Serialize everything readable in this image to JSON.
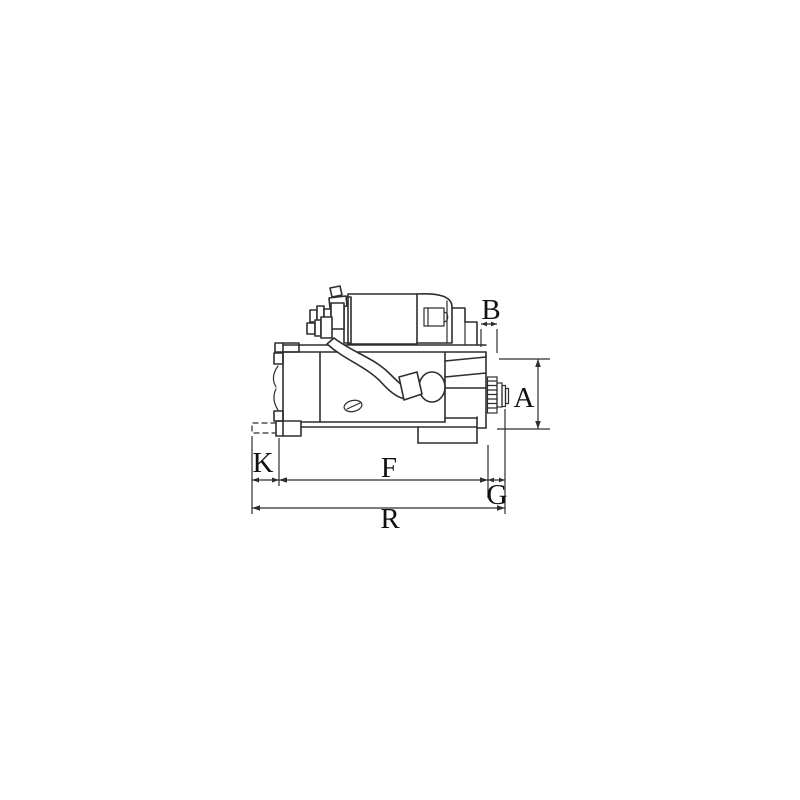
{
  "page": {
    "background_color": "#ffffff"
  },
  "diagram": {
    "kind": "technical-dimension-drawing",
    "subject": "starter motor side view",
    "line_color": "#2e2e2e",
    "label_color": "#111111",
    "labels": {
      "b": "B",
      "a": "A",
      "k": "K",
      "f": "F",
      "g": "G",
      "r": "R"
    }
  }
}
